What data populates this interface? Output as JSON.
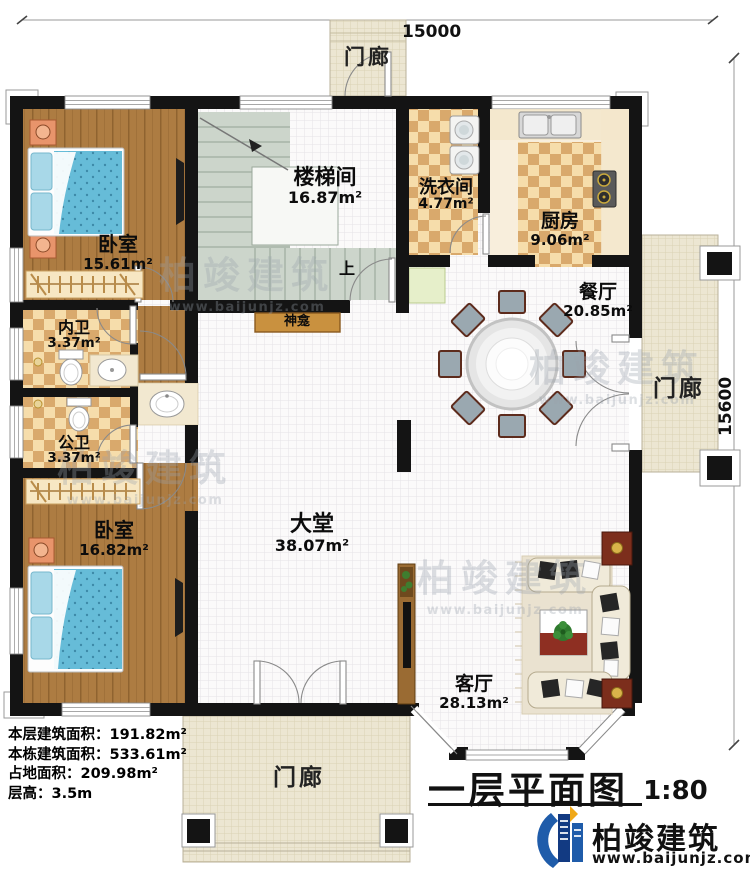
{
  "title": {
    "main": "一层平面图",
    "scale": "1:80"
  },
  "dimensions": {
    "width": "15000",
    "height": "15600"
  },
  "rooms": {
    "bedroom1": {
      "name": "卧室",
      "area": "15.61m²"
    },
    "stairwell": {
      "name": "楼梯间",
      "area": "16.87m²"
    },
    "laundry": {
      "name": "洗衣间",
      "area": "4.77m²"
    },
    "kitchen": {
      "name": "厨房",
      "area": "9.06m²"
    },
    "dining": {
      "name": "餐厅",
      "area": "20.85m²"
    },
    "bath_inner": {
      "name": "内卫",
      "area": "3.37m²"
    },
    "bath_public": {
      "name": "公卫",
      "area": "3.37m²"
    },
    "hall": {
      "name": "大堂",
      "area": "38.07m²"
    },
    "bedroom2": {
      "name": "卧室",
      "area": "16.82m²"
    },
    "living": {
      "name": "客厅",
      "area": "28.13m²"
    }
  },
  "porches": {
    "top": "门廊",
    "right": "门廊",
    "bottom": "门廊"
  },
  "features": {
    "shrine": "神龛",
    "stairs_up": "上"
  },
  "stats": [
    "本层建筑面积：191.82m²",
    "本栋建筑面积：533.61m²",
    "占地面积：209.98m²",
    "层高：3.5m"
  ],
  "brand": {
    "name": "柏竣建筑",
    "url": "www.baijunjz.com"
  },
  "watermark": {
    "text": "柏竣建筑",
    "url": "www.baijunjz.com"
  },
  "colors": {
    "brand_blue": "#1f5caa",
    "brand_orange": "#f0a818",
    "wall": "#141414"
  }
}
